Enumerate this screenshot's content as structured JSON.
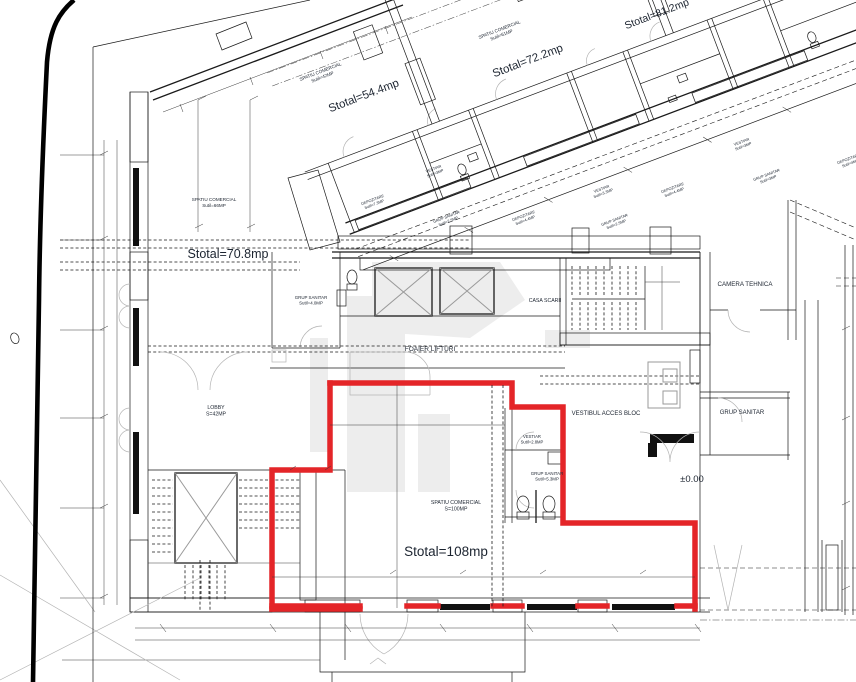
{
  "drawing": {
    "type": "architectural-floor-plan",
    "highlight_color": "#e42528",
    "line_color": "#1a1a1a",
    "labels": [
      {
        "id": "room-spatiu-comercial-54",
        "lines": [
          "SPATIU COMERCIAL",
          "Sutil=42MP"
        ],
        "x": 321,
        "y": 73,
        "rot": -21,
        "size": 4.6,
        "bold": false
      },
      {
        "id": "area-stotal-54",
        "lines": [
          "Stotal=54.4mp"
        ],
        "x": 365,
        "y": 99,
        "rot": -21,
        "size": 11.5,
        "bold": false
      },
      {
        "id": "room-spatiu-comercial-72",
        "lines": [
          "SPATIU COMERCIAL",
          "Sutil=61MP"
        ],
        "x": 500,
        "y": 31,
        "rot": -21,
        "size": 4.6,
        "bold": false
      },
      {
        "id": "area-stotal-72",
        "lines": [
          "Stotal=72.2mp"
        ],
        "x": 529,
        "y": 64,
        "rot": -21,
        "size": 11.5,
        "bold": false
      },
      {
        "id": "area-stotal-81",
        "lines": [
          "Stotal=81.2mp"
        ],
        "x": 658,
        "y": 17,
        "rot": -21,
        "size": 10.5,
        "bold": false
      },
      {
        "id": "room-spatiu-comercial-70",
        "lines": [
          "SPATIU COMERCIAL",
          "Sutil=66MP"
        ],
        "x": 214,
        "y": 201,
        "rot": 0,
        "size": 4.6,
        "bold": false
      },
      {
        "id": "area-stotal-70",
        "lines": [
          "Stotal=70.8mp"
        ],
        "x": 228,
        "y": 258,
        "rot": 0,
        "size": 12.5,
        "bold": false
      },
      {
        "id": "room-depozitare-1",
        "lines": [
          "DEPOZITARE",
          "Sutil=7.3MP"
        ],
        "x": 373,
        "y": 201,
        "rot": -21,
        "size": 3.8,
        "bold": false
      },
      {
        "id": "room-vestiar-1",
        "lines": [
          "VESTIAR",
          "Sutil=3MP"
        ],
        "x": 434,
        "y": 170,
        "rot": -21,
        "size": 3.8,
        "bold": false
      },
      {
        "id": "room-grup-sanitar-1",
        "lines": [
          "GRUP SANITAR",
          "Sutil=2.5MP"
        ],
        "x": 447,
        "y": 218,
        "rot": -21,
        "size": 3.8,
        "bold": false
      },
      {
        "id": "room-depozitare-2",
        "lines": [
          "DEPOZITARE",
          "Sutil=4.4MP"
        ],
        "x": 524,
        "y": 217,
        "rot": -21,
        "size": 3.8,
        "bold": false
      },
      {
        "id": "room-vestiar-2",
        "lines": [
          "VESTIAR",
          "Sutil=3.3MP"
        ],
        "x": 602,
        "y": 190,
        "rot": -21,
        "size": 3.8,
        "bold": false
      },
      {
        "id": "room-grup-sanitar-2",
        "lines": [
          "GRUP SANITAR",
          "Sutil=2.5MP"
        ],
        "x": 615,
        "y": 221,
        "rot": -21,
        "size": 3.8,
        "bold": false
      },
      {
        "id": "room-depozitare-3",
        "lines": [
          "DEPOZITARE",
          "Sutil=4.4MP"
        ],
        "x": 673,
        "y": 189,
        "rot": -21,
        "size": 3.8,
        "bold": false
      },
      {
        "id": "room-vestiar-3",
        "lines": [
          "VESTIAR",
          "Sutil=3MP"
        ],
        "x": 742,
        "y": 143,
        "rot": -21,
        "size": 3.8,
        "bold": false
      },
      {
        "id": "room-grup-sanitar-3",
        "lines": [
          "GRUP SANITAR",
          "Sutil=3MP"
        ],
        "x": 767,
        "y": 176,
        "rot": -21,
        "size": 3.8,
        "bold": false
      },
      {
        "id": "room-depozitare-4",
        "lines": [
          "DEPOZITARE",
          "Sutil=4MP"
        ],
        "x": 849,
        "y": 160,
        "rot": -21,
        "size": 3.8,
        "bold": false
      },
      {
        "id": "room-grup-sanitar-lift",
        "lines": [
          "GRUP SANITAR",
          "Sutil=4.0MP"
        ],
        "x": 311,
        "y": 299,
        "rot": 0,
        "size": 4.4,
        "bold": false
      },
      {
        "id": "room-foaier-lifturi",
        "lines": [
          "FOAIER LIFTURI"
        ],
        "x": 430,
        "y": 351,
        "rot": 0,
        "size": 6.5,
        "bold": false
      },
      {
        "id": "room-casa-scarii",
        "lines": [
          "CASA SCARII"
        ],
        "x": 545,
        "y": 302,
        "rot": 0,
        "size": 5.2,
        "bold": false
      },
      {
        "id": "room-camera-tehnica",
        "lines": [
          "CAMERA TEHNICA"
        ],
        "x": 745,
        "y": 286,
        "rot": 0,
        "size": 6.2,
        "bold": false
      },
      {
        "id": "room-lobby",
        "lines": [
          "LOBBY",
          "S=42MP"
        ],
        "x": 216,
        "y": 409,
        "rot": 0,
        "size": 5.2,
        "bold": false
      },
      {
        "id": "room-vestibul-acces-bloc",
        "lines": [
          "VESTIBUL ACCES BLOC"
        ],
        "x": 606,
        "y": 415,
        "rot": 0,
        "size": 6,
        "bold": false
      },
      {
        "id": "room-grup-sanitar-right",
        "lines": [
          "GRUP SANITAR"
        ],
        "x": 742,
        "y": 414,
        "rot": 0,
        "size": 6,
        "bold": false
      },
      {
        "id": "room-vestiar-parter",
        "lines": [
          "VESTIAR",
          "Sutil=2.8MP"
        ],
        "x": 532,
        "y": 438,
        "rot": 0,
        "size": 4.2,
        "bold": false
      },
      {
        "id": "room-grup-sanitar-parter",
        "lines": [
          "GRUP SANITAR",
          "Sutil=5.3MP"
        ],
        "x": 547,
        "y": 475,
        "rot": 0,
        "size": 4.4,
        "bold": false
      },
      {
        "id": "room-spatiu-comercial-108",
        "lines": [
          "SPATIU COMERCIAL",
          "S=100MP"
        ],
        "x": 456,
        "y": 504,
        "rot": 0,
        "size": 5.2,
        "bold": false
      },
      {
        "id": "area-stotal-108",
        "lines": [
          "Stotal=108mp"
        ],
        "x": 446,
        "y": 556,
        "rot": 0,
        "size": 13.5,
        "bold": false
      },
      {
        "id": "level-marker",
        "lines": [
          "±0.00"
        ],
        "x": 692,
        "y": 482,
        "rot": 0,
        "size": 9.5,
        "bold": false
      }
    ]
  }
}
